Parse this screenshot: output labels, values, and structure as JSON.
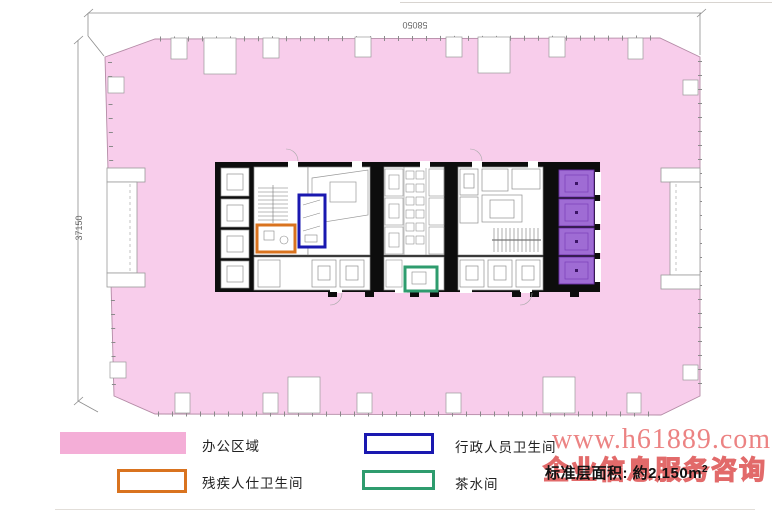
{
  "plan": {
    "dimensions": {
      "top": "58050",
      "left": "37150"
    },
    "colors": {
      "office_pink": "#f8cdeb",
      "legend_pink": "#f4aed7",
      "disabled_orange": "#d9731f",
      "admin_blue": "#1a18b0",
      "tea_green": "#2e9c6e",
      "lift_purple": "#9f6cd4",
      "wall_black": "#0d0d0d"
    }
  },
  "legend": {
    "items": [
      {
        "id": "office-area",
        "label": "办公区域"
      },
      {
        "id": "disabled-toilet",
        "label": "残疾人仕卫生间"
      },
      {
        "id": "admin-toilet",
        "label": "行政人员卫生间"
      },
      {
        "id": "tea-room",
        "label": "茶水间"
      }
    ]
  },
  "area_note": {
    "prefix": "标准层面积: 約",
    "value": "2,150m",
    "sup": "2"
  },
  "watermark": {
    "line1": "www.h61889.com",
    "line2": "企业信息服务咨询"
  }
}
